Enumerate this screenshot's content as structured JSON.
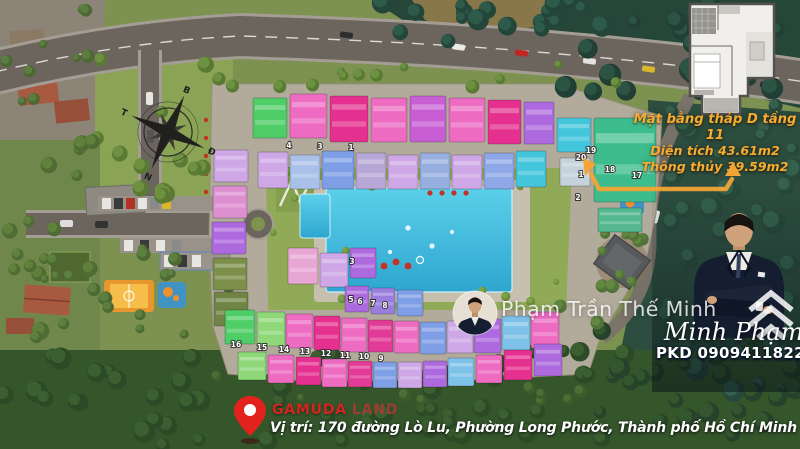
{
  "inset": {
    "lines": [
      "Mặt bằng tháp D tầng 11",
      "Diện tích 43.61m2",
      "Thông thủy 39.59m2"
    ],
    "text_color": "#f5ac31",
    "arrow_color": "#f2a435"
  },
  "watermark": {
    "name": "Phạm Trần Thế Minh"
  },
  "agent": {
    "name": "Minh Phạm",
    "phone": "PKD 0909411822"
  },
  "footer": {
    "brand": "GAMUDA",
    "brand_suffix": "LAND",
    "address": "Vị trí: 170 đường Lò Lu, Phường Long Phước, Thành phố Hồ Chí Minh",
    "pin_color": "#e2231d",
    "brand_color": "#d3241f"
  },
  "compass": {
    "north": "B",
    "east": "Đ",
    "south": "N",
    "west": "T"
  },
  "site_plan": {
    "pool_color": "#3fc0e2",
    "buildings": [
      [
        253,
        98,
        34,
        40,
        "#4fce67"
      ],
      [
        290,
        94,
        37,
        44,
        "#ee6bc2"
      ],
      [
        330,
        96,
        38,
        46,
        "#e5308f"
      ],
      [
        371,
        98,
        36,
        44,
        "#ee6bc2"
      ],
      [
        410,
        96,
        36,
        46,
        "#c75ed4"
      ],
      [
        449,
        98,
        36,
        44,
        "#ee6bc2"
      ],
      [
        488,
        100,
        33,
        44,
        "#e5308f"
      ],
      [
        524,
        102,
        30,
        42,
        "#ad69de"
      ],
      [
        557,
        118,
        34,
        34,
        "#43c6dc"
      ],
      [
        258,
        152,
        30,
        36,
        "#cda7e6"
      ],
      [
        290,
        155,
        30,
        34,
        "#a9c0e8"
      ],
      [
        322,
        151,
        32,
        38,
        "#7e9ee6"
      ],
      [
        356,
        153,
        30,
        36,
        "#b7a7d6"
      ],
      [
        388,
        155,
        30,
        34,
        "#cda7e6"
      ],
      [
        420,
        153,
        30,
        36,
        "#97afdf"
      ],
      [
        452,
        155,
        30,
        34,
        "#cda7e6"
      ],
      [
        484,
        153,
        30,
        36,
        "#8ea7e6"
      ],
      [
        516,
        151,
        30,
        36,
        "#43c6dc"
      ],
      [
        594,
        118,
        62,
        84,
        "#3dbd8d"
      ],
      [
        560,
        158,
        30,
        28,
        "#c5d2dc"
      ],
      [
        598,
        208,
        44,
        24,
        "#54b891"
      ],
      [
        214,
        150,
        34,
        32,
        "#cda7e6"
      ],
      [
        213,
        186,
        34,
        32,
        "#de8fd0"
      ],
      [
        212,
        222,
        34,
        32,
        "#ad69de"
      ],
      [
        213,
        258,
        34,
        32,
        "#7c8f4a"
      ],
      [
        214,
        292,
        34,
        34,
        "#6f8445"
      ],
      [
        288,
        248,
        30,
        36,
        "#e8a6d5"
      ],
      [
        320,
        253,
        28,
        34,
        "#cda7e6"
      ],
      [
        350,
        248,
        26,
        30,
        "#ad69de"
      ],
      [
        345,
        286,
        24,
        26,
        "#ad69de"
      ],
      [
        371,
        288,
        24,
        26,
        "#9a7ede"
      ],
      [
        397,
        290,
        26,
        26,
        "#7e9ee6"
      ],
      [
        225,
        310,
        30,
        34,
        "#4fce67"
      ],
      [
        257,
        312,
        28,
        34,
        "#8ed87a"
      ],
      [
        286,
        314,
        27,
        34,
        "#ee6bc2"
      ],
      [
        314,
        316,
        26,
        34,
        "#e5308f"
      ],
      [
        341,
        318,
        26,
        34,
        "#ee6bc2"
      ],
      [
        368,
        320,
        25,
        32,
        "#e23a97"
      ],
      [
        394,
        321,
        25,
        32,
        "#ee6bc2"
      ],
      [
        420,
        322,
        26,
        32,
        "#7e9ee6"
      ],
      [
        447,
        321,
        26,
        32,
        "#cda7e6"
      ],
      [
        474,
        319,
        27,
        34,
        "#ad69de"
      ],
      [
        502,
        316,
        28,
        34,
        "#7fc2e9"
      ],
      [
        531,
        312,
        28,
        36,
        "#ee6bc2"
      ],
      [
        238,
        352,
        28,
        28,
        "#8ed87a"
      ],
      [
        268,
        355,
        26,
        28,
        "#ee6bc2"
      ],
      [
        296,
        357,
        25,
        28,
        "#e5308f"
      ],
      [
        322,
        359,
        25,
        28,
        "#ee6bc2"
      ],
      [
        348,
        361,
        24,
        26,
        "#e23a97"
      ],
      [
        373,
        362,
        24,
        26,
        "#7e9ee6"
      ],
      [
        398,
        362,
        24,
        26,
        "#cda7e6"
      ],
      [
        423,
        361,
        24,
        26,
        "#ad69de"
      ],
      [
        448,
        358,
        26,
        28,
        "#7fc2e9"
      ],
      [
        476,
        355,
        26,
        28,
        "#ee6bc2"
      ],
      [
        504,
        350,
        28,
        30,
        "#e5308f"
      ],
      [
        534,
        344,
        28,
        32,
        "#ad69de"
      ]
    ],
    "unit_labels": [
      {
        "n": "4",
        "x": 289,
        "y": 148
      },
      {
        "n": "3",
        "x": 320,
        "y": 149
      },
      {
        "n": "1",
        "x": 351,
        "y": 150
      },
      {
        "n": "20",
        "x": 581,
        "y": 160
      },
      {
        "n": "19",
        "x": 591,
        "y": 153
      },
      {
        "n": "18",
        "x": 610,
        "y": 172
      },
      {
        "n": "17",
        "x": 637,
        "y": 178
      },
      {
        "n": "1",
        "x": 581,
        "y": 177
      },
      {
        "n": "2",
        "x": 578,
        "y": 200
      },
      {
        "n": "3",
        "x": 352,
        "y": 264
      },
      {
        "n": "5",
        "x": 351,
        "y": 302
      },
      {
        "n": "6",
        "x": 360,
        "y": 304
      },
      {
        "n": "7",
        "x": 373,
        "y": 306
      },
      {
        "n": "8",
        "x": 385,
        "y": 308
      },
      {
        "n": "16",
        "x": 236,
        "y": 347
      },
      {
        "n": "15",
        "x": 262,
        "y": 350
      },
      {
        "n": "14",
        "x": 284,
        "y": 352
      },
      {
        "n": "13",
        "x": 305,
        "y": 354
      },
      {
        "n": "12",
        "x": 326,
        "y": 356
      },
      {
        "n": "11",
        "x": 345,
        "y": 358
      },
      {
        "n": "10",
        "x": 364,
        "y": 359
      },
      {
        "n": "9",
        "x": 381,
        "y": 361
      }
    ]
  }
}
